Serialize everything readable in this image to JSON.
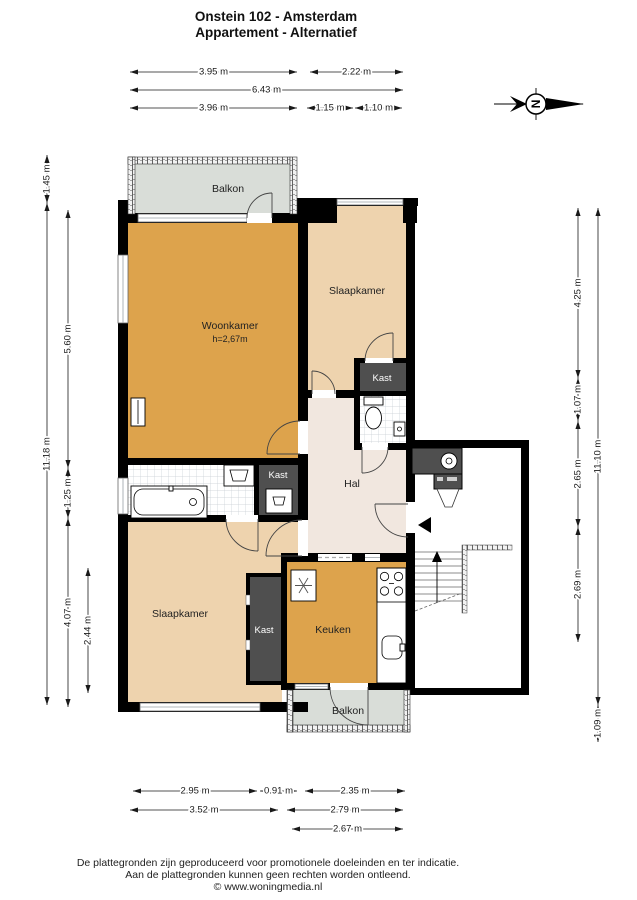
{
  "title": {
    "line1": "Onstein 102 - Amsterdam",
    "line2": "Appartement - Alternatief"
  },
  "compass": {
    "north_label": "N"
  },
  "rooms": {
    "balkon_top": "Balkon",
    "woonkamer": "Woonkamer",
    "woonkamer_height": "h=2,67m",
    "slaapkamer_top": "Slaapkamer",
    "kast_top": "Kast",
    "hal": "Hal",
    "kast_washok": "Kast",
    "slaapkamer_bottom": "Slaapkamer",
    "kast_bottom": "Kast",
    "keuken": "Keuken",
    "balkon_bottom": "Balkon"
  },
  "dimensions": {
    "top": [
      {
        "value": "3.95 m",
        "from": 130,
        "to": 297,
        "at": 72
      },
      {
        "value": "2.22 m",
        "from": 310,
        "to": 403,
        "at": 72
      },
      {
        "value": "6.43 m",
        "from": 130,
        "to": 403,
        "at": 90
      },
      {
        "value": "3.96 m",
        "from": 130,
        "to": 297,
        "at": 108
      },
      {
        "value": "1.15 m",
        "from": 307,
        "to": 353,
        "at": 108
      },
      {
        "value": "1.10 m",
        "from": 355,
        "to": 402,
        "at": 108
      }
    ],
    "bottom": [
      {
        "value": "2.95 m",
        "from": 133,
        "to": 257,
        "at": 791
      },
      {
        "value": "0.91 m",
        "from": 260,
        "to": 297,
        "at": 791
      },
      {
        "value": "2.35 m",
        "from": 305,
        "to": 405,
        "at": 791
      },
      {
        "value": "3.52 m",
        "from": 130,
        "to": 278,
        "at": 810
      },
      {
        "value": "2.79 m",
        "from": 287,
        "to": 403,
        "at": 810
      },
      {
        "value": "2.67 m",
        "from": 292,
        "to": 403,
        "at": 829
      }
    ],
    "left": [
      {
        "value": "1.45 m",
        "from": 155,
        "to": 203,
        "at": 47
      },
      {
        "value": "11.18 m",
        "from": 203,
        "to": 705,
        "at": 47
      },
      {
        "value": "5.60 m",
        "from": 210,
        "to": 468,
        "at": 68
      },
      {
        "value": "1.25 m",
        "from": 468,
        "to": 518,
        "at": 68
      },
      {
        "value": "4.07 m",
        "from": 518,
        "to": 707,
        "at": 68
      },
      {
        "value": "2.44 m",
        "from": 568,
        "to": 693,
        "at": 88
      }
    ],
    "right": [
      {
        "value": "4.25 m",
        "from": 208,
        "to": 378,
        "at": 578
      },
      {
        "value": "1.07 m",
        "from": 378,
        "to": 421,
        "at": 578
      },
      {
        "value": "2.65 m",
        "from": 421,
        "to": 527,
        "at": 578
      },
      {
        "value": "2.69 m",
        "from": 527,
        "to": 642,
        "at": 578
      },
      {
        "value": "11.10 m",
        "from": 208,
        "to": 705,
        "at": 598
      },
      {
        "value": "1.09 m",
        "from": 705,
        "to": 742,
        "at": 598
      }
    ]
  },
  "footer": {
    "line1": "De plattegronden zijn geproduceerd voor promotionele doeleinden en ter indicatie.",
    "line2": "Aan de plattegronden kunnen geen rechten worden ontleend.",
    "line3": "© www.woningmedia.nl"
  },
  "colors": {
    "wall": "#000000",
    "woonkamer": "#DDA34C",
    "keuken": "#DDA34C",
    "slaapkamer": "#EED3AE",
    "hal": "#F1E7DF",
    "balkon": "#D9DDD8",
    "kast": "#4F4F4F",
    "stairwell": "#FFFFFF"
  }
}
